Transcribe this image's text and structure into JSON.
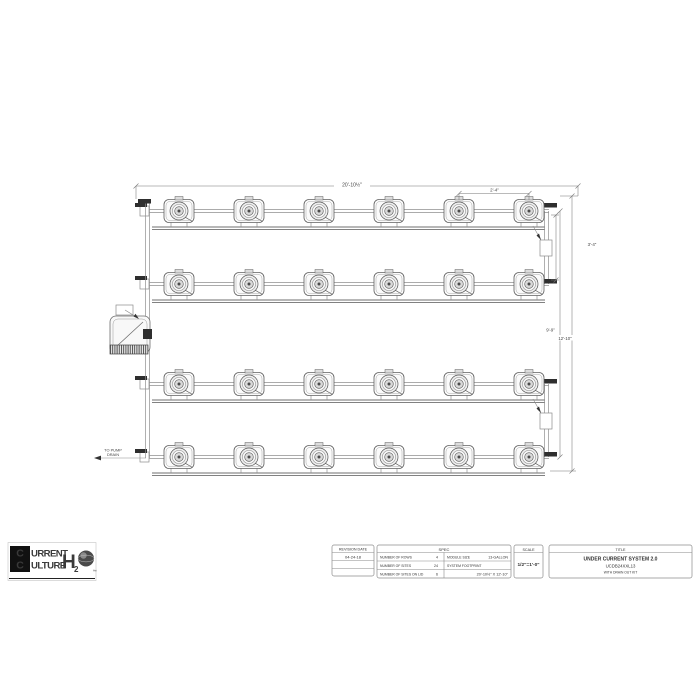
{
  "drawing": {
    "rows": 4,
    "cols": 6,
    "dim_overall_width": "20'-10½\"",
    "dim_col_spacing": "2'-4\"",
    "dim_row_spacing": "3'-4\"",
    "dim_inner_height": "9'-9\"",
    "dim_overall_height": "12'-10\"",
    "drain_label_line1": "TO PUMP",
    "drain_label_line2": "DRAIN"
  },
  "logo": {
    "word1_initial": "C",
    "word1_rest": "URRENT",
    "word2_initial": "C",
    "word2_rest": "ULTURE",
    "h": "H",
    "sub": "2",
    "tm": "™"
  },
  "title_block": {
    "revision": {
      "header": "REVISION DATE",
      "date": "04-24-18"
    },
    "spec": {
      "header": "SPEC",
      "rows_label": "NUMBER OF ROWS",
      "rows_value": "4",
      "sites_label": "NUMBER OF SITES",
      "sites_value": "24",
      "lid_label": "NUMBER OF SITES ON LID",
      "lid_value": "6",
      "module_label": "MODULE SIZE",
      "module_value": "13-GALLON",
      "footprint_label": "SYSTEM FOOTPRINT",
      "footprint_value": "20'-10½\" X 12'-10\""
    },
    "scale": {
      "header": "SCALE",
      "value": "1/2\"=1'-0\""
    },
    "title": {
      "header": "TITLE",
      "line1": "UNDER CURRENT SYSTEM 2.0",
      "line2": "UCDB24XXL13",
      "line3": "WITH DRAIN OUT KIT"
    }
  }
}
